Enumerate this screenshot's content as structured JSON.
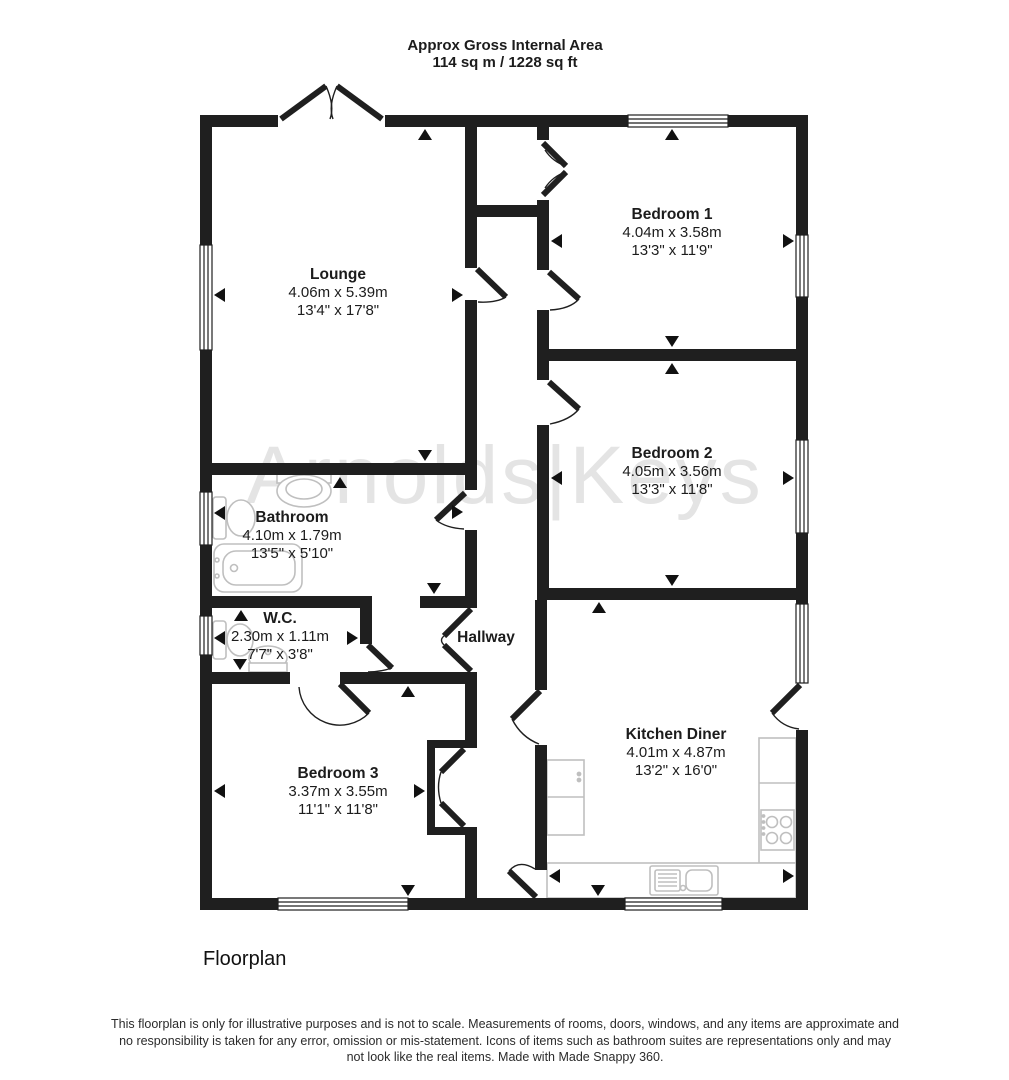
{
  "header": {
    "line1": "Approx Gross Internal Area",
    "line2": "114 sq m / 1228 sq ft"
  },
  "watermark": {
    "text": "Arnolds|Keys"
  },
  "rooms": {
    "lounge": {
      "name": "Lounge",
      "metric": "4.06m x 5.39m",
      "imperial": "13'4\" x 17'8\""
    },
    "bedroom1": {
      "name": "Bedroom 1",
      "metric": "4.04m x 3.58m",
      "imperial": "13'3\" x 11'9\""
    },
    "bedroom2": {
      "name": "Bedroom 2",
      "metric": "4.05m x 3.56m",
      "imperial": "13'3\" x 11'8\""
    },
    "bathroom": {
      "name": "Bathroom",
      "metric": "4.10m x 1.79m",
      "imperial": "13'5\" x 5'10\""
    },
    "wc": {
      "name": "W.C.",
      "metric": "2.30m x 1.11m",
      "imperial": "7'7\" x 3'8\""
    },
    "hallway": {
      "name": "Hallway"
    },
    "bedroom3": {
      "name": "Bedroom 3",
      "metric": "3.37m x 3.55m",
      "imperial": "11'1\" x 11'8\""
    },
    "kitchen_diner": {
      "name": "Kitchen Diner",
      "metric": "4.01m x 4.87m",
      "imperial": "13'2\" x 16'0\""
    }
  },
  "footer": {
    "caption": "Floorplan",
    "disclaimer": "This floorplan is only for illustrative purposes and is not to scale. Measurements of rooms, doors, windows, and any items are approximate and no responsibility is taken for any error, omission or mis-statement. Icons of items such as bathroom suites are representations only and may not look like the real items. Made with Made Snappy 360."
  },
  "colors": {
    "wall": "#1f1f1f",
    "watermark": "#e4e4e4",
    "fixture": "#bfbfbf",
    "text": "#1c1c1c"
  }
}
